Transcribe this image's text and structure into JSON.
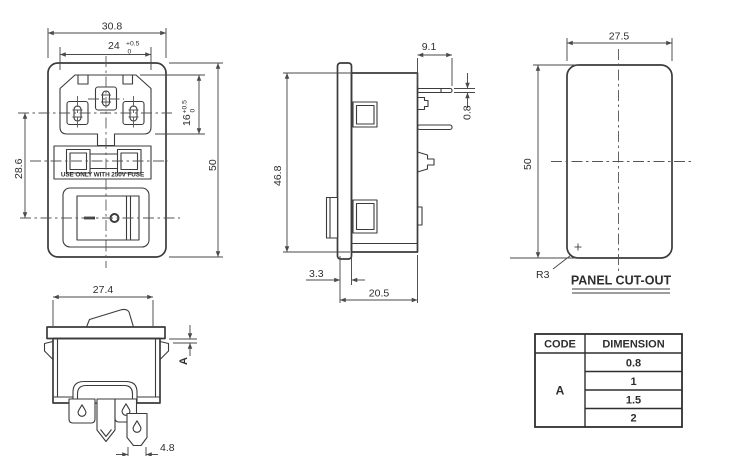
{
  "views": {
    "front": {
      "dim_overall_width": "30.8",
      "recess_width": {
        "value": "24",
        "tol_upper": "+0.5",
        "tol_lower": "0"
      },
      "recess_height": {
        "value": "16",
        "tol_upper": "+0.5",
        "tol_lower": "0"
      },
      "dim_center_spacing": "28.6",
      "dim_overall_height": "50",
      "fuse_warning": "USE ONLY WITH 250V FUSE"
    },
    "side": {
      "dim_pin_length": "9.1",
      "dim_pin_thickness": "0.8",
      "dim_body_height": "46.8",
      "dim_flange_thickness": "3.3",
      "dim_mount_depth": "20.5"
    },
    "cutout": {
      "dim_width": "27.5",
      "dim_height": "50",
      "corner_radius": "R3",
      "caption": "PANEL CUT-OUT"
    },
    "switch": {
      "dim_width": "27.4",
      "panel_code": "A",
      "dim_terminal": "4.8"
    }
  },
  "table": {
    "header_code": "CODE",
    "header_dimension": "DIMENSION",
    "code": "A",
    "values": [
      "0.8",
      "1",
      "1.5",
      "2"
    ]
  },
  "colors": {
    "line": "#3b3b3b",
    "dimension": "#4a4a4a",
    "text": "#2e2e2e",
    "background": "#ffffff"
  }
}
